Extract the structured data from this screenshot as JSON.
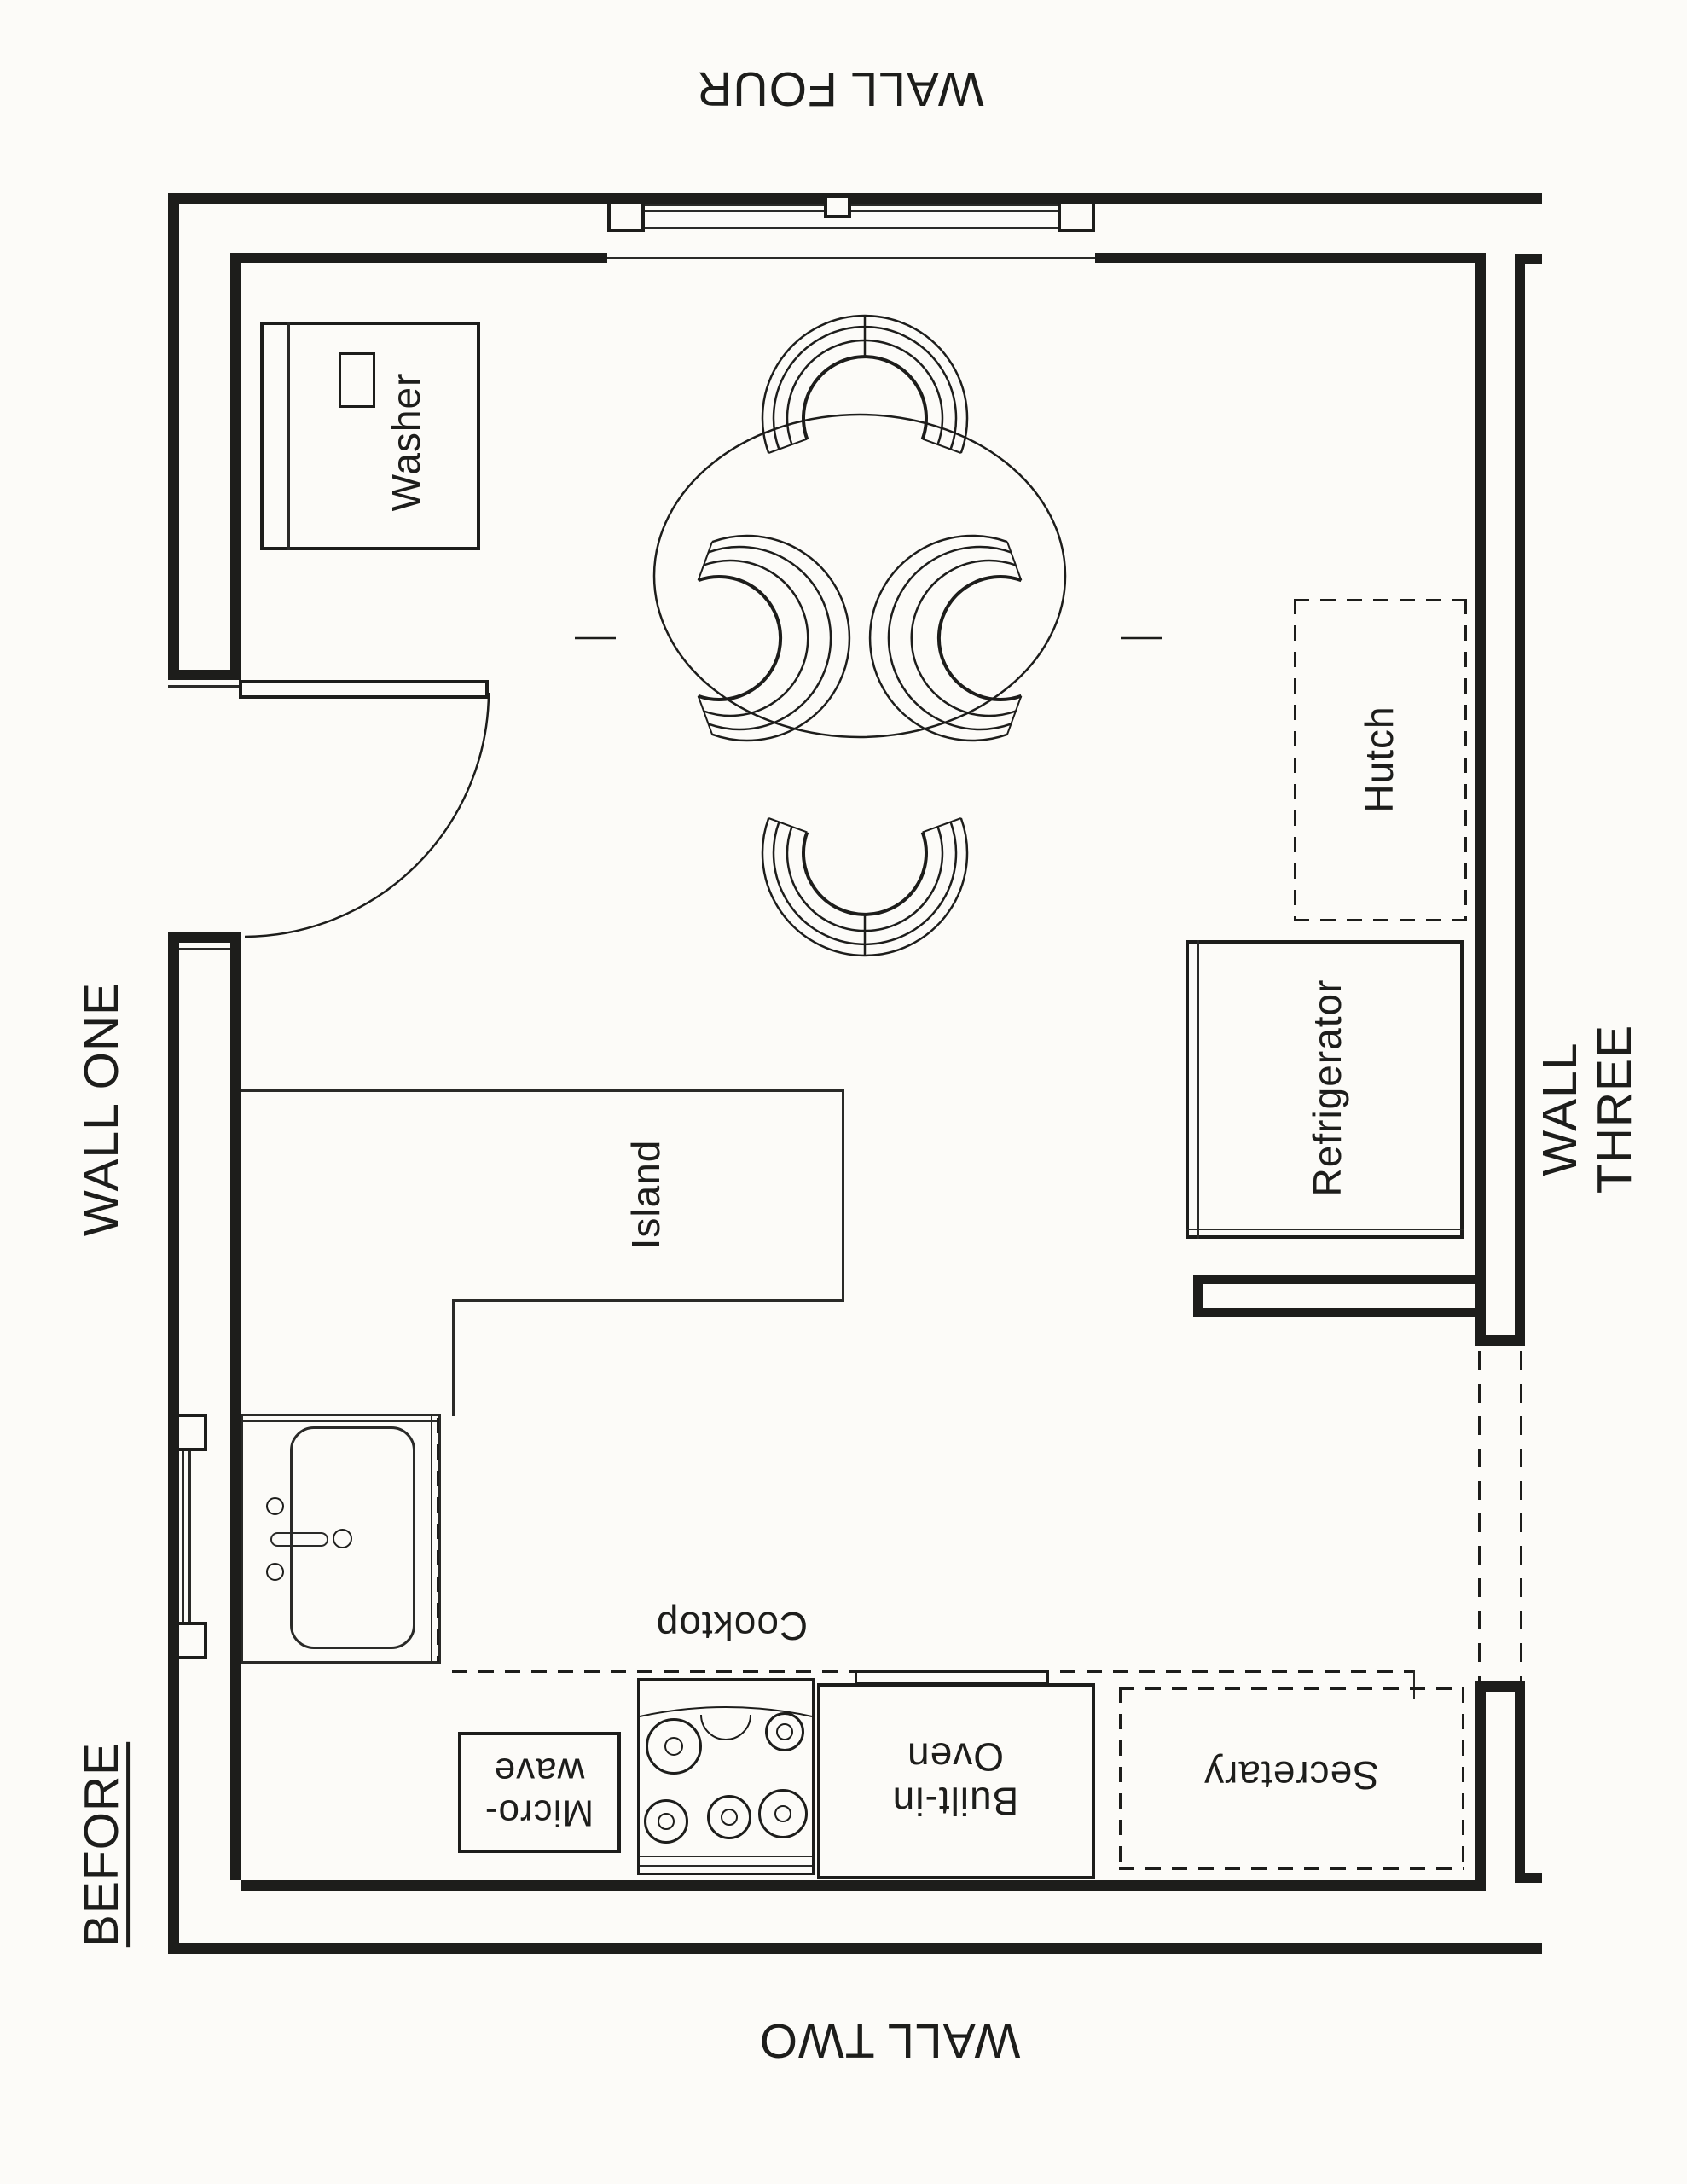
{
  "colors": {
    "line": "#1d1d1b",
    "background": "#fcfbf8"
  },
  "labels": {
    "wall_one": "WALL ONE",
    "wall_two": "WALL TWO",
    "wall_three": "WALL THREE",
    "wall_four": "WALL FOUR",
    "before": "BEFORE",
    "washer": "Washer",
    "hutch": "Hutch",
    "refrigerator": "Refrigerator",
    "island": "Island",
    "cooktop": "Cooktop",
    "microwave": "Micro-\nwave",
    "built_in_oven": "Built-in\nOven",
    "secretary": "Secretary"
  }
}
